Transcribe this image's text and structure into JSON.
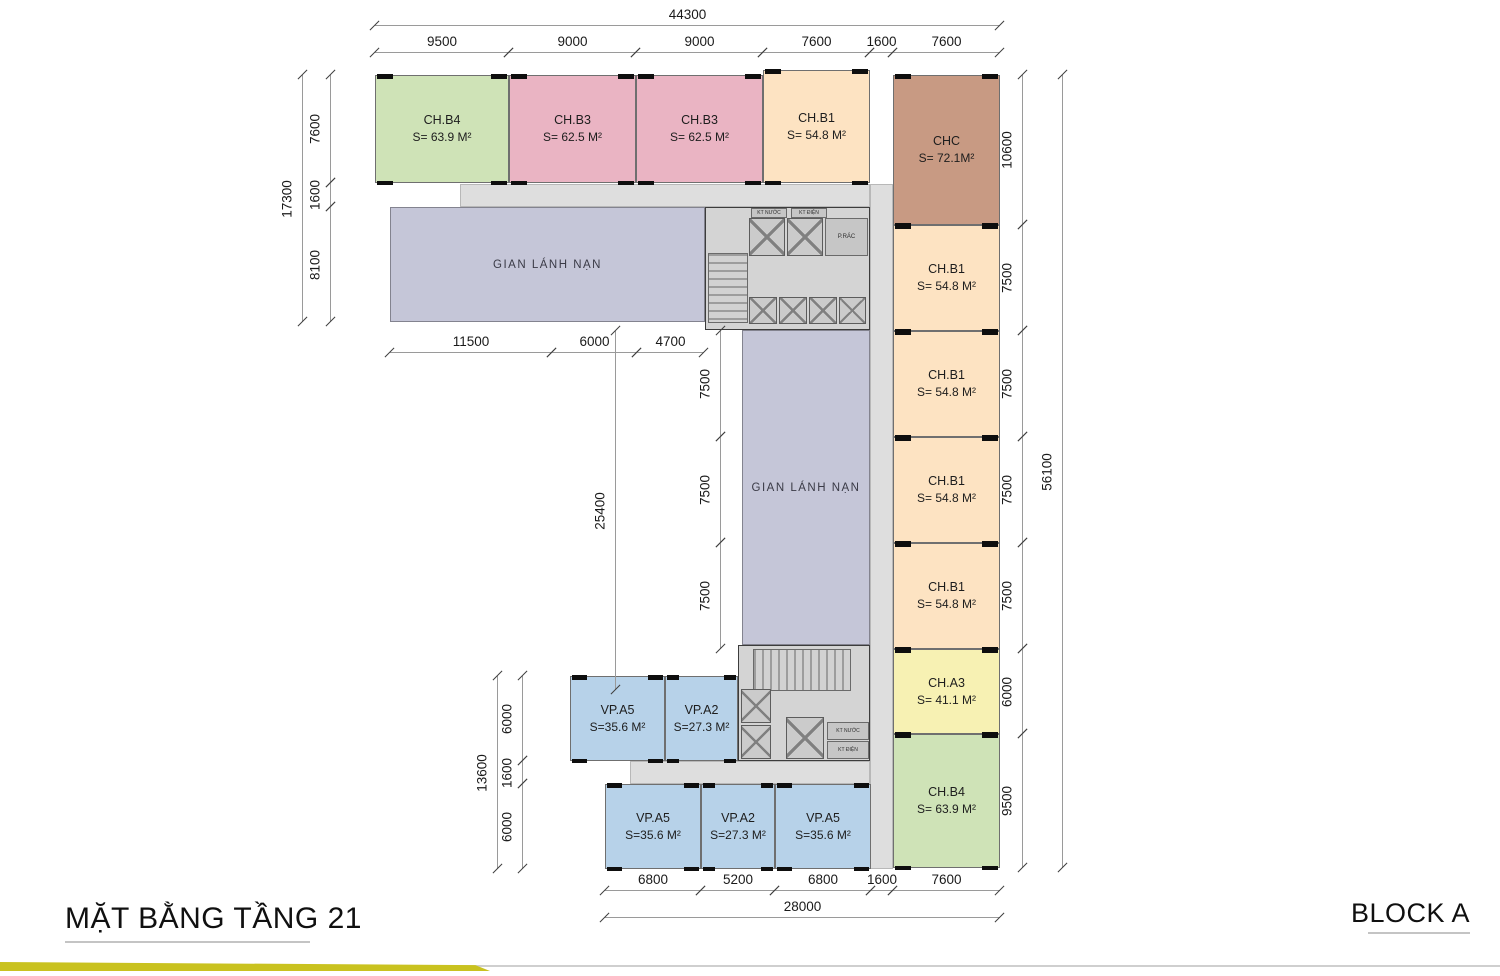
{
  "meta": {
    "title": "MẶT BẰNG TẦNG 21",
    "block": "BLOCK A"
  },
  "colors": {
    "green": "#cfe3b7",
    "pink": "#eab4c3",
    "peach": "#fde3c2",
    "tan": "#c89a83",
    "yellow": "#f7f1b3",
    "blue": "#b7d2e9",
    "lavender": "#c5c6d8",
    "corridor": "#dedede",
    "core": "#d4d4d4",
    "wall": "#0e0e0e",
    "footer_bar": "#c9c21f"
  },
  "rooms": [
    {
      "id": "ch-b4-top",
      "label": "CH.B4",
      "area": "S= 63.9 M²",
      "color": "green",
      "x": 375,
      "y": 75,
      "w": 134,
      "h": 108
    },
    {
      "id": "ch-b3-1",
      "label": "CH.B3",
      "area": "S= 62.5 M²",
      "color": "pink",
      "x": 509,
      "y": 75,
      "w": 127,
      "h": 108
    },
    {
      "id": "ch-b3-2",
      "label": "CH.B3",
      "area": "S= 62.5 M²",
      "color": "pink",
      "x": 636,
      "y": 75,
      "w": 127,
      "h": 108
    },
    {
      "id": "ch-b1-top",
      "label": "CH.B1",
      "area": "S= 54.8 M²",
      "color": "peach",
      "x": 763,
      "y": 70,
      "w": 107,
      "h": 113
    },
    {
      "id": "chc",
      "label": "CHC",
      "area": "S= 72.1M²",
      "color": "tan",
      "x": 893,
      "y": 75,
      "w": 107,
      "h": 150
    },
    {
      "id": "ch-b1-1",
      "label": "CH.B1",
      "area": "S= 54.8 M²",
      "color": "peach",
      "x": 893,
      "y": 225,
      "w": 107,
      "h": 106
    },
    {
      "id": "ch-b1-2",
      "label": "CH.B1",
      "area": "S= 54.8 M²",
      "color": "peach",
      "x": 893,
      "y": 331,
      "w": 107,
      "h": 106
    },
    {
      "id": "ch-b1-3",
      "label": "CH.B1",
      "area": "S= 54.8 M²",
      "color": "peach",
      "x": 893,
      "y": 437,
      "w": 107,
      "h": 106
    },
    {
      "id": "ch-b1-4",
      "label": "CH.B1",
      "area": "S= 54.8 M²",
      "color": "peach",
      "x": 893,
      "y": 543,
      "w": 107,
      "h": 106
    },
    {
      "id": "ch-a3",
      "label": "CH.A3",
      "area": "S= 41.1 M²",
      "color": "yellow",
      "x": 893,
      "y": 649,
      "w": 107,
      "h": 85
    },
    {
      "id": "ch-b4-bottom",
      "label": "CH.B4",
      "area": "S= 63.9 M²",
      "color": "green",
      "x": 893,
      "y": 734,
      "w": 107,
      "h": 134
    },
    {
      "id": "vp-a5-up",
      "label": "VP.A5",
      "area": "S=35.6 M²",
      "color": "blue",
      "x": 570,
      "y": 676,
      "w": 95,
      "h": 85
    },
    {
      "id": "vp-a2-up",
      "label": "VP.A2",
      "area": "S=27.3 M²",
      "color": "blue",
      "x": 665,
      "y": 676,
      "w": 73,
      "h": 85
    },
    {
      "id": "vp-a5-low-1",
      "label": "VP.A5",
      "area": "S=35.6 M²",
      "color": "blue",
      "x": 605,
      "y": 784,
      "w": 96,
      "h": 85
    },
    {
      "id": "vp-a2-low",
      "label": "VP.A2",
      "area": "S=27.3 M²",
      "color": "blue",
      "x": 701,
      "y": 784,
      "w": 74,
      "h": 85
    },
    {
      "id": "vp-a5-low-2",
      "label": "VP.A5",
      "area": "S=35.6 M²",
      "color": "blue",
      "x": 775,
      "y": 784,
      "w": 96,
      "h": 85
    }
  ],
  "refuges": [
    {
      "id": "refuge-horizontal",
      "label": "GIAN LÁNH NẠN",
      "x": 390,
      "y": 207,
      "w": 315,
      "h": 115
    },
    {
      "id": "refuge-vertical",
      "label": "GIAN LÁNH NẠN",
      "x": 742,
      "y": 330,
      "w": 128,
      "h": 315
    }
  ],
  "corridors": [
    {
      "id": "corridor-top",
      "x": 460,
      "y": 184,
      "w": 410,
      "h": 23
    },
    {
      "id": "corridor-spine",
      "x": 870,
      "y": 184,
      "w": 23,
      "h": 685
    },
    {
      "id": "corridor-bottom",
      "x": 630,
      "y": 761,
      "w": 240,
      "h": 23
    }
  ],
  "cores": [
    {
      "id": "core-top",
      "x": 705,
      "y": 207,
      "w": 165,
      "h": 123,
      "stairs": {
        "x": 2,
        "y": 45,
        "w": 40,
        "h": 70,
        "dir": "h"
      },
      "elevators": [
        {
          "x": 43,
          "y": 10,
          "w": 36,
          "h": 38
        },
        {
          "x": 81,
          "y": 10,
          "w": 36,
          "h": 38
        },
        {
          "x": 43,
          "y": 89,
          "w": 28,
          "h": 27
        },
        {
          "x": 73,
          "y": 89,
          "w": 28,
          "h": 27
        },
        {
          "x": 103,
          "y": 89,
          "w": 28,
          "h": 27
        },
        {
          "x": 133,
          "y": 89,
          "w": 27,
          "h": 27
        }
      ],
      "rooms": [
        {
          "x": 119,
          "y": 10,
          "w": 43,
          "h": 38,
          "label": "P.RÁC"
        }
      ],
      "shafts": [
        {
          "x": 45,
          "y": 0,
          "w": 36,
          "h": 10,
          "label": "KT NƯỚC"
        },
        {
          "x": 85,
          "y": 0,
          "w": 36,
          "h": 10,
          "label": "KT ĐIỆN"
        }
      ]
    },
    {
      "id": "core-bottom",
      "x": 738,
      "y": 645,
      "w": 132,
      "h": 116,
      "stairs": {
        "x": 14,
        "y": 3,
        "w": 98,
        "h": 42,
        "dir": "v"
      },
      "elevators": [
        {
          "x": 2,
          "y": 43,
          "w": 30,
          "h": 34
        },
        {
          "x": 2,
          "y": 79,
          "w": 30,
          "h": 34
        },
        {
          "x": 47,
          "y": 71,
          "w": 38,
          "h": 42
        }
      ],
      "rooms": [],
      "shafts": [
        {
          "x": 88,
          "y": 76,
          "w": 42,
          "h": 18,
          "label": "KT NƯỚC"
        },
        {
          "x": 88,
          "y": 95,
          "w": 42,
          "h": 18,
          "label": "KT ĐIỆN"
        }
      ]
    }
  ],
  "dims": [
    {
      "t": "44300",
      "o": "h",
      "x": 375,
      "y": 25,
      "len": 625
    },
    {
      "t": "9500",
      "o": "h",
      "x": 375,
      "y": 52,
      "len": 134
    },
    {
      "t": "9000",
      "o": "h",
      "x": 509,
      "y": 52,
      "len": 127
    },
    {
      "t": "9000",
      "o": "h",
      "x": 636,
      "y": 52,
      "len": 127
    },
    {
      "t": "7600",
      "o": "h",
      "x": 763,
      "y": 52,
      "len": 107
    },
    {
      "t": "1600",
      "o": "h",
      "x": 870,
      "y": 52,
      "len": 23
    },
    {
      "t": "7600",
      "o": "h",
      "x": 893,
      "y": 52,
      "len": 107
    },
    {
      "t": "17300",
      "o": "v",
      "x": 302,
      "y": 75,
      "len": 247
    },
    {
      "t": "7600",
      "o": "v",
      "x": 330,
      "y": 75,
      "len": 108
    },
    {
      "t": "1600",
      "o": "v",
      "x": 330,
      "y": 183,
      "len": 24
    },
    {
      "t": "8100",
      "o": "v",
      "x": 330,
      "y": 207,
      "len": 115
    },
    {
      "t": "11500",
      "o": "h",
      "x": 390,
      "y": 352,
      "len": 162
    },
    {
      "t": "6000",
      "o": "h",
      "x": 552,
      "y": 352,
      "len": 85
    },
    {
      "t": "4700",
      "o": "h",
      "x": 637,
      "y": 352,
      "len": 67
    },
    {
      "t": "25400",
      "o": "v",
      "x": 615,
      "y": 331,
      "len": 359
    },
    {
      "t": "7500",
      "o": "v",
      "x": 720,
      "y": 331,
      "len": 106
    },
    {
      "t": "7500",
      "o": "v",
      "x": 720,
      "y": 437,
      "len": 106
    },
    {
      "t": "7500",
      "o": "v",
      "x": 720,
      "y": 543,
      "len": 106
    },
    {
      "t": "13600",
      "o": "v",
      "x": 497,
      "y": 676,
      "len": 193
    },
    {
      "t": "6000",
      "o": "v",
      "x": 522,
      "y": 676,
      "len": 85
    },
    {
      "t": "1600",
      "o": "v",
      "x": 522,
      "y": 761,
      "len": 23
    },
    {
      "t": "6000",
      "o": "v",
      "x": 522,
      "y": 784,
      "len": 85
    },
    {
      "t": "10600",
      "o": "v",
      "x": 1022,
      "y": 75,
      "len": 150
    },
    {
      "t": "7500",
      "o": "v",
      "x": 1022,
      "y": 225,
      "len": 106
    },
    {
      "t": "7500",
      "o": "v",
      "x": 1022,
      "y": 331,
      "len": 106
    },
    {
      "t": "7500",
      "o": "v",
      "x": 1022,
      "y": 437,
      "len": 106
    },
    {
      "t": "7500",
      "o": "v",
      "x": 1022,
      "y": 543,
      "len": 106
    },
    {
      "t": "6000",
      "o": "v",
      "x": 1022,
      "y": 649,
      "len": 85
    },
    {
      "t": "9500",
      "o": "v",
      "x": 1022,
      "y": 734,
      "len": 134
    },
    {
      "t": "56100",
      "o": "v",
      "x": 1062,
      "y": 75,
      "len": 793
    },
    {
      "t": "6800",
      "o": "h",
      "x": 605,
      "y": 890,
      "len": 96
    },
    {
      "t": "5200",
      "o": "h",
      "x": 701,
      "y": 890,
      "len": 74
    },
    {
      "t": "6800",
      "o": "h",
      "x": 775,
      "y": 890,
      "len": 96
    },
    {
      "t": "1600",
      "o": "h",
      "x": 871,
      "y": 890,
      "len": 22
    },
    {
      "t": "7600",
      "o": "h",
      "x": 893,
      "y": 890,
      "len": 107
    },
    {
      "t": "28000",
      "o": "h",
      "x": 605,
      "y": 917,
      "len": 395
    }
  ],
  "footer": {
    "title_pos": {
      "x": 65,
      "y": 902
    },
    "block_pos": {
      "x": 1470,
      "y": 902
    }
  }
}
